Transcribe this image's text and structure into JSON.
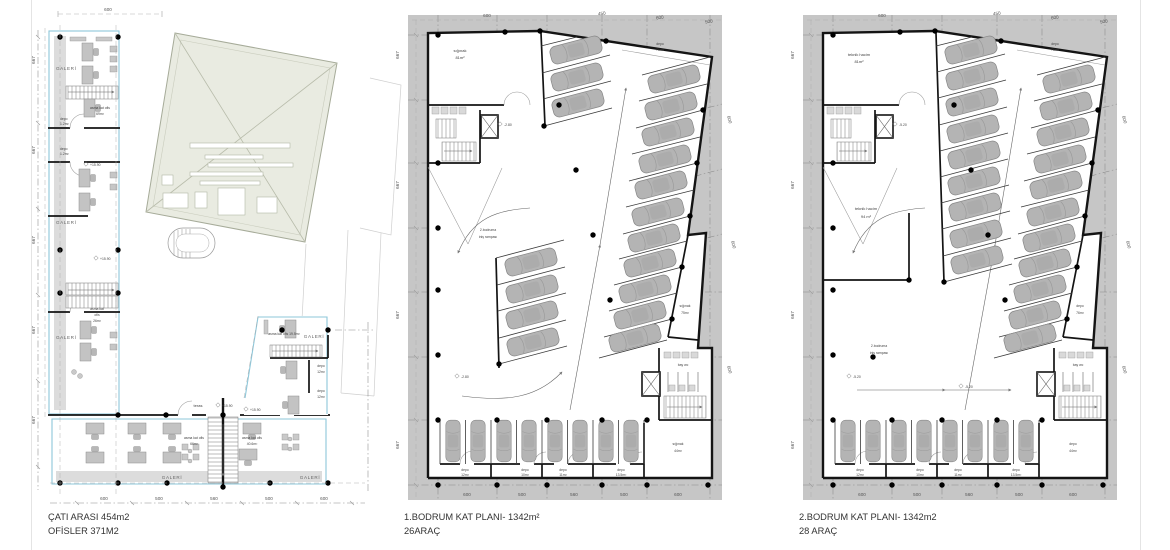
{
  "dims": {
    "d600": "600",
    "d500": "500",
    "d560": "560",
    "d450": "450",
    "d667": "667"
  },
  "plan1": {
    "caption1": "ÇATI ARASI 454m2",
    "caption2": "OFİSLER 371M2",
    "galeri": "GALERİ",
    "teras": "teras",
    "level": "+15.90",
    "ofis69": [
      "asma kat ofis",
      "69m²"
    ],
    "ofis26": [
      "asma kat",
      "ofis",
      "26m²"
    ],
    "ofis66": [
      "asma kat ofis",
      "66m²"
    ],
    "ofis46": [
      "asma kat ofis",
      "40.6m²"
    ],
    "ofis19": "asma kat ofis 19.5m²",
    "depo_small": [
      "depo",
      "1.2m²"
    ],
    "depo12": [
      "depo",
      "12m²"
    ]
  },
  "plan2": {
    "caption1": "1.BODRUM KAT PLANI- 1342m²",
    "caption2": "26ARAÇ",
    "room_tl": [
      "sığınak",
      "81m²"
    ],
    "room_tr": [
      "depo",
      "76m²"
    ],
    "room_r": [
      "sığınak",
      "75m²"
    ],
    "room_br": [
      "sığınak",
      "44m²"
    ],
    "wc": "bay wc",
    "ramp": [
      "2.bodruma",
      "iniş rampası"
    ],
    "level": "-2.80",
    "depot1": [
      "depo",
      "12m²"
    ],
    "depot2": [
      "depo",
      "10m²"
    ],
    "depot3": [
      "depo",
      "11m²"
    ],
    "depot4": [
      "depo",
      "13.5m²"
    ]
  },
  "plan3": {
    "caption1": "2.BODRUM KAT PLANI- 1342m2",
    "caption2": "28 ARAÇ",
    "room_tl": [
      "teknik hacim",
      "81m²"
    ],
    "room_tr": [
      "depo",
      "76m²"
    ],
    "room_ml": [
      "teknik hacim",
      "94 m²"
    ],
    "room_r": [
      "depo",
      "76m²"
    ],
    "room_br": [
      "depo",
      "44m²"
    ],
    "wc": "bay wc",
    "ramp": [
      "2.bodruma",
      "iniş rampası"
    ],
    "level": "-5.20",
    "depot1": [
      "depo",
      "12m²"
    ],
    "depot2": [
      "depo",
      "10m²"
    ],
    "depot3": [
      "depo",
      "11m²"
    ],
    "depot4": [
      "depo",
      "13.5m²"
    ]
  }
}
